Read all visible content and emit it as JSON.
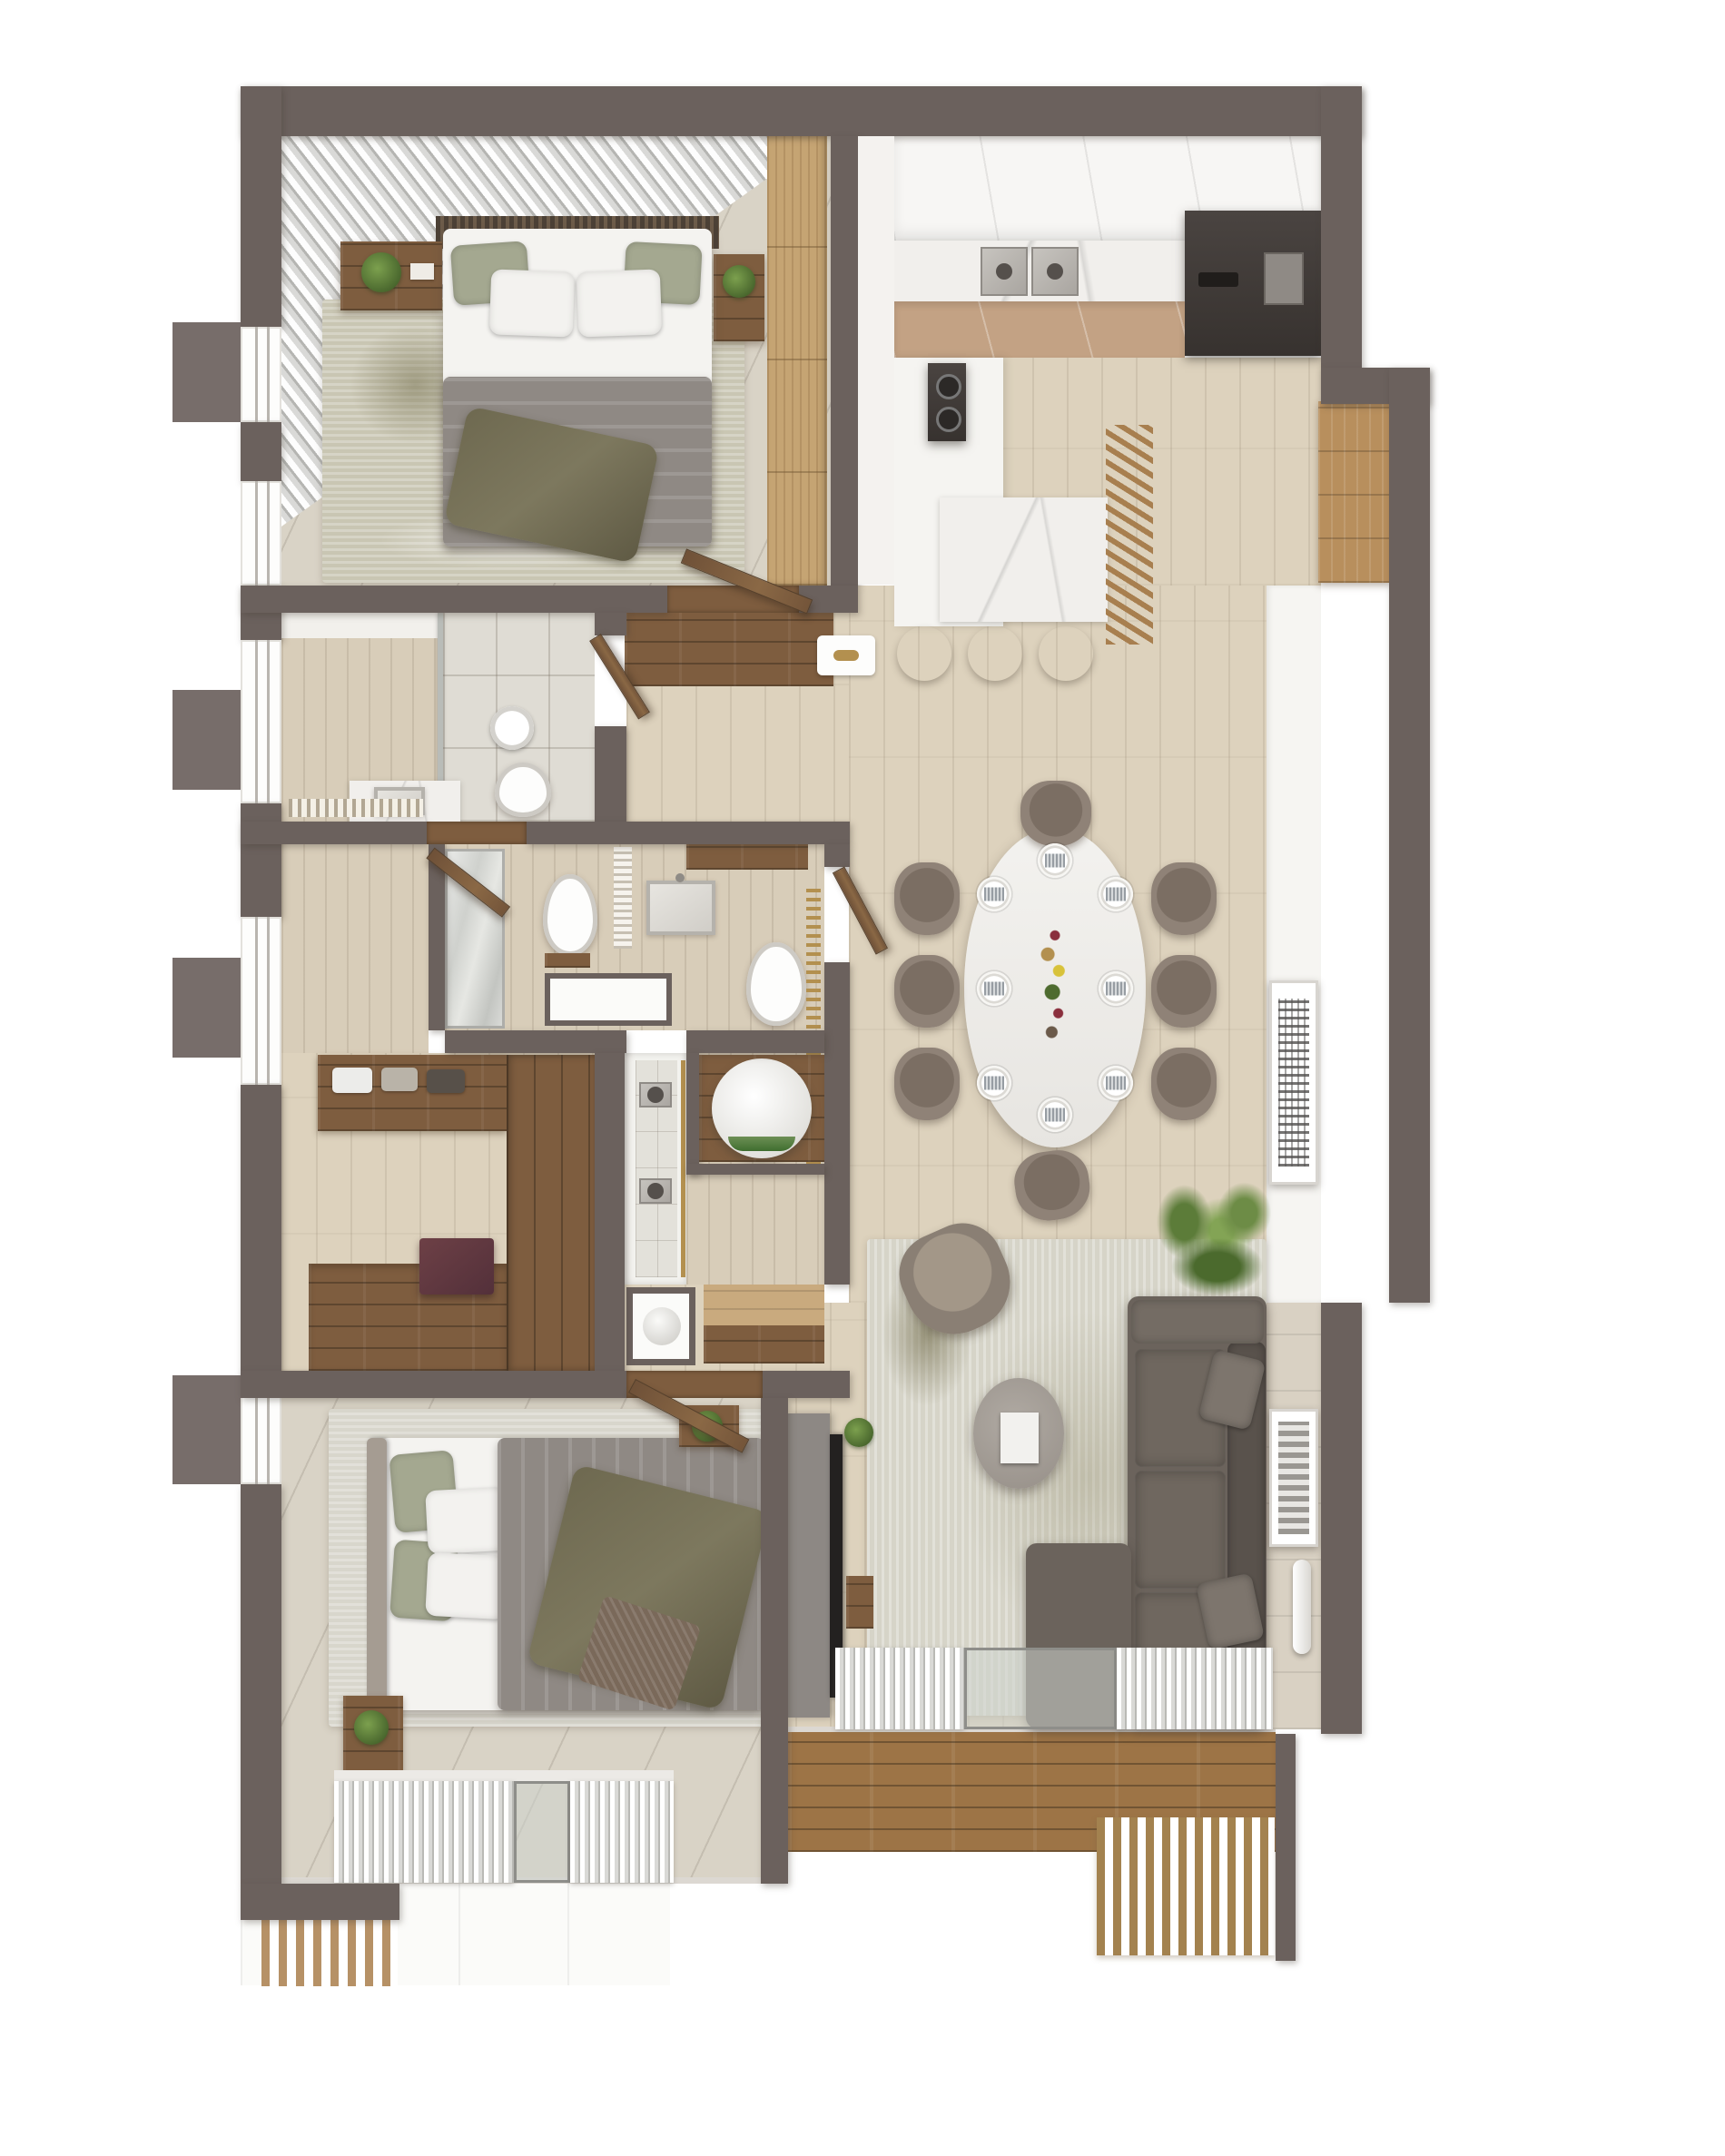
{
  "scene": {
    "type": "3d-floor-plan-top-down-render",
    "description": "Photorealistic top-down 3D render of a two-bedroom apartment with open kitchen-dining-living area, two bathrooms, walk-in closet and two balconies",
    "style": "warm neutral taupe, oak and marble interior"
  },
  "palette": {
    "paper": "#ffffff",
    "wall": "#6b615d",
    "floorPale": "#ddd2bd",
    "tile": "#d9d3c6",
    "walnut": "#7e5d3f",
    "woodMid": "#c9aa7e",
    "deck": "#9d7446",
    "rugBeige": "#c9c6b3",
    "rugLive": "#d6d4c8",
    "sofa": "#6b635c",
    "sofaDark": "#59524c",
    "marble": "#f1efec",
    "gold": "#b3904f",
    "duvet": "#8f8984",
    "boilerGreen": "#3f6e2f",
    "appliance": "#403b38",
    "accentBurgundy": "#63393f",
    "plantGreen": "#5f7d3c"
  },
  "rooms": [
    {
      "name": "master-bedroom",
      "position": "top-left",
      "furniture": [
        "double-bed",
        "grey-duvet",
        "olive-throw",
        "slatted-headboard-panel",
        "nightstand-left-with-plant",
        "nightstand-right-with-plant",
        "tall-oak-wardrobe",
        "diagonal-sheer-curtains",
        "area-rug",
        "diagonal-stone-tile-floor"
      ]
    },
    {
      "name": "kitchen",
      "position": "top-right",
      "furniture": [
        "white-upper-cabinets",
        "double-stainless-sink",
        "marble-backsplash-counter",
        "dark-fridge-oven-column",
        "tan-base-cabinets",
        "peninsula-with-cooktop",
        "marble-breakfast-bar",
        "wood-slat-screen",
        "bar-stools",
        "tall-wood-cabinet"
      ]
    },
    {
      "name": "bathroom-1",
      "position": "middle-left",
      "furniture": [
        "walk-in-shower-glass",
        "rain-shower-head",
        "wall-hung-toilet",
        "marble-vanity-basin",
        "striped-drain-mat",
        "window"
      ]
    },
    {
      "name": "ensuite-bathroom",
      "position": "center",
      "furniture": [
        "mirror-wall",
        "wall-hung-toilet",
        "towel-radiator",
        "square-basin",
        "storage-niche",
        "long-walk-in-shower",
        "brass-slat-screen",
        "water-heater-cylinder-closet",
        "wc-toilet",
        "walnut-shelf"
      ]
    },
    {
      "name": "walk-in-closet",
      "position": "left-center",
      "furniture": [
        "l-shaped-walnut-wardrobe",
        "open-shelves-with-folded-clothes",
        "burgundy-ottoman",
        "window"
      ]
    },
    {
      "name": "hallway",
      "position": "center",
      "furniture": [
        "open-walnut-doors",
        "door-mat-with-gold-detail",
        "storage-niche-with-vase",
        "wood-console",
        "walnut-floor-inlay"
      ]
    },
    {
      "name": "dining-area",
      "position": "center-right",
      "furniture": [
        "oval-dining-table",
        "upholstered-dining-chairs",
        "place-settings",
        "centerpiece-flowers-and-candles",
        "abstract-wall-art"
      ]
    },
    {
      "name": "living-room",
      "position": "bottom-right",
      "furniture": [
        "sectional-sofa-with-chaise",
        "throw-pillows",
        "round-coffee-table-with-magazine",
        "accent-armchair",
        "palm-plant",
        "area-rug",
        "tv-media-panel",
        "floor-lamp",
        "abstract-wall-art",
        "tiled-accent-wall"
      ]
    },
    {
      "name": "second-bedroom",
      "position": "bottom-left",
      "furniture": [
        "double-bed",
        "grey-duvet",
        "olive-throw",
        "knit-blanket",
        "upholstered-headboard",
        "nightstand-with-plant",
        "dresser-with-plant",
        "wall-slat-radiator-panel",
        "area-rug",
        "curtains-with-sliding-door"
      ]
    },
    {
      "name": "balcony-left",
      "position": "bottom-left-outside",
      "furniture": [
        "white-slab-floor",
        "wood-pergola-slats"
      ]
    },
    {
      "name": "balcony-right",
      "position": "bottom-outside",
      "furniture": [
        "hardwood-deck",
        "wood-slat-bench",
        "sliding-glass-door",
        "curtain-panels"
      ]
    }
  ],
  "counts": {
    "bedrooms": 2,
    "bathrooms": 2,
    "dining_chairs": 8,
    "dining_place_settings": 8,
    "bar_stools": 3,
    "balconies": 2,
    "windows_left_wall": 5
  }
}
